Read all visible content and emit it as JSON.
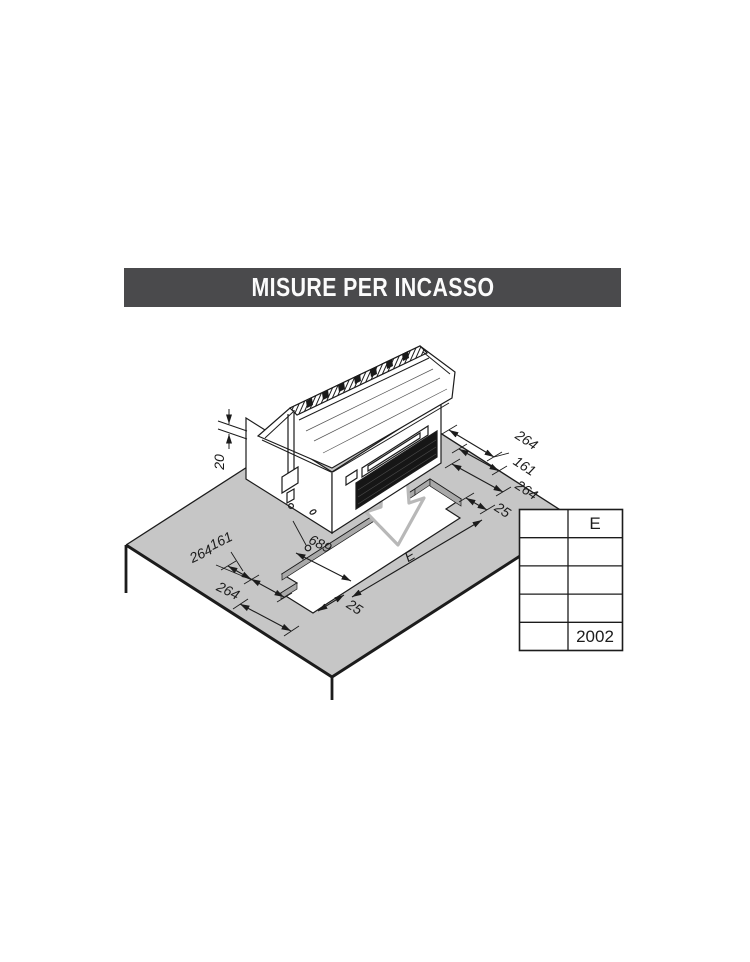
{
  "title": {
    "text": "MISURE PER INCASSO"
  },
  "colors": {
    "title_bar": "#4a4a4c",
    "counter_top": "#c6c6c6",
    "cut_face": "#a9a9a9",
    "line": "#1c1c1c",
    "arrow_outline": "#b8b8b8"
  },
  "dims": {
    "lip_height": "20",
    "right_264_a": "264",
    "right_161": "161",
    "right_264_b": "264",
    "right_25": "25",
    "left_161": "161",
    "left_264_a": "264",
    "left_264_b": "264",
    "left_25": "25",
    "cut_width": "689",
    "cut_length": "E"
  },
  "table": {
    "header_col2": "E",
    "value_col2_row5": "2002",
    "empty_rows": 3
  }
}
